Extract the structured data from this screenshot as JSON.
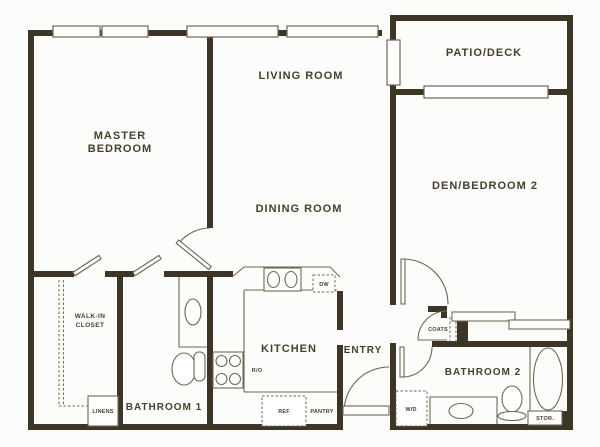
{
  "colors": {
    "wall": "#3d3626",
    "line": "#6e6753",
    "text": "#473f2c",
    "background": "#fcfcfa"
  },
  "labels": {
    "master_bedroom_line1": "MASTER",
    "master_bedroom_line2": "BEDROOM",
    "living_room": "LIVING ROOM",
    "dining_room": "DINING ROOM",
    "patio_deck": "PATIO/DECK",
    "den_bedroom2": "DEN/BEDROOM 2",
    "kitchen": "KITCHEN",
    "entry": "ENTRY",
    "bathroom1": "BATHROOM 1",
    "bathroom2": "BATHROOM 2",
    "walk_in_closet_line1": "WALK-IN",
    "walk_in_closet_line2": "CLOSET",
    "linens": "LINENS",
    "coats": "COATS",
    "washer_dryer": "W/D",
    "refrigerator": "REF",
    "pantry": "PANTRY",
    "dishwasher": "DW",
    "range_oven": "R/O",
    "storage": "STOR."
  }
}
